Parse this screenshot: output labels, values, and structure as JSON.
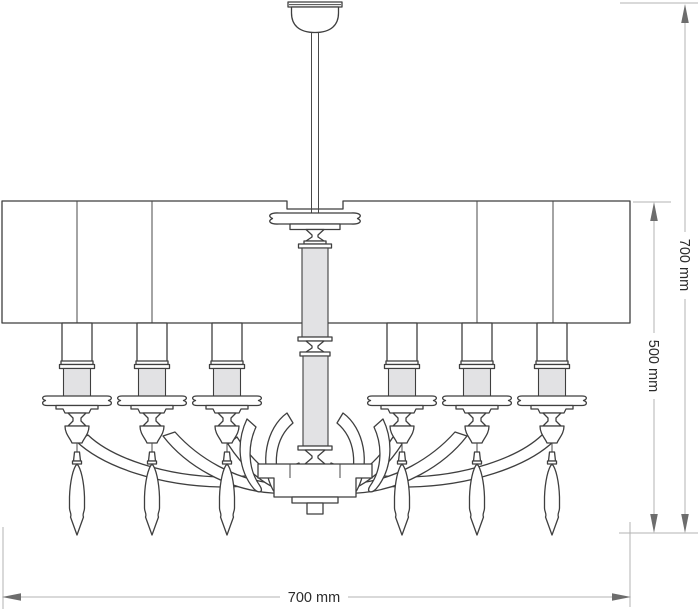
{
  "drawing": {
    "subject": "chandelier technical dimension drawing",
    "dimensions": {
      "total_height_label": "700 mm",
      "body_height_label": "500 mm",
      "width_label": "700 mm"
    },
    "colors": {
      "background": "#ffffff",
      "outline": "#3f3f3f",
      "grey_fill": "#e2e2e4",
      "dimension_line": "#b3b3b3",
      "arrowhead": "#6d6d6d",
      "label_text": "#2b2b2b"
    }
  }
}
